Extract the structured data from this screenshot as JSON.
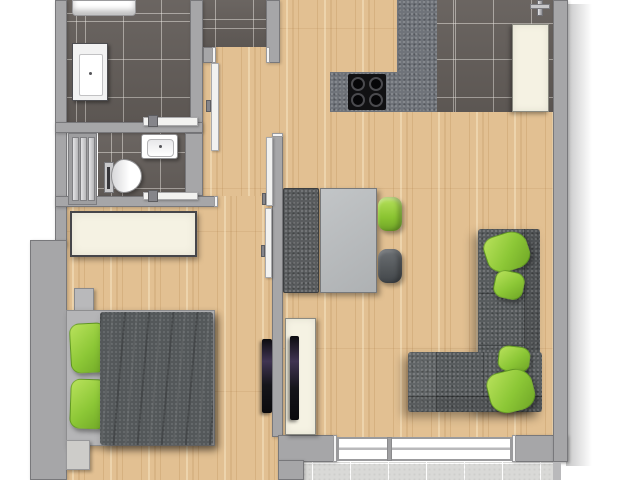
{
  "scene": {
    "kind": "apartment-floor-plan-top-down-render",
    "canvas": {
      "width": 640,
      "height": 480
    },
    "visible_text": "none"
  },
  "palette": {
    "outside_background": "#ffffff",
    "wall_fill": "#a6a6a8",
    "wall_border": "#78787b",
    "wall_cut_cap": "#f4f4f4",
    "wood_floor": "#e2c092",
    "wood_grain": "#ab7c42",
    "dark_tile_floor": "#635d59",
    "tile_grout": "#eeeae4",
    "balcony_tile": "#d9d9d7",
    "granite_counter": "#6f737a",
    "furniture_dark_gray": "#585c5e",
    "furniture_light_gray": "#b8bbbd",
    "cream_cabinet": "#f5f2e3",
    "accent_green": "#8fc63c",
    "appliance_black": "#141414",
    "tv_sheen_purple": "#403452"
  },
  "rooms": [
    {
      "id": "bathroom",
      "floor": "dark-tile",
      "contents": [
        "shower-tray",
        "washing-machine"
      ]
    },
    {
      "id": "wc",
      "floor": "dark-tile",
      "contents": [
        "shelf-unit",
        "sink",
        "toilet"
      ]
    },
    {
      "id": "entry-vestibule",
      "floor": "dark-tile",
      "contents": [
        "entry-door"
      ]
    },
    {
      "id": "hallway",
      "floor": "wood",
      "contents": [
        "sliding-door-bars",
        "interior-doors"
      ]
    },
    {
      "id": "kitchen",
      "floor": "dark-tile",
      "contents": [
        "l-shaped-granite-counter",
        "cooktop",
        "sink-faucet",
        "tall-cream-cabinet"
      ]
    },
    {
      "id": "living-dining",
      "floor": "wood",
      "contents": [
        "dining-bench",
        "dining-table",
        "green-chair",
        "gray-chair",
        "corner-sofa",
        "sofa-pillows",
        "tv-lowboard",
        "living-tv",
        "window-front"
      ]
    },
    {
      "id": "bedroom",
      "floor": "wood",
      "contents": [
        "wardrobe",
        "bed-frame",
        "green-pillows",
        "dark-duvet",
        "nightstand-top",
        "nightstand-bottom",
        "wall-tv"
      ]
    },
    {
      "id": "balcony",
      "floor": "light-tile",
      "contents": []
    }
  ],
  "furniture_colors": {
    "sofa": "#585c5e",
    "duvet": "#54585a",
    "pillows_and_chairs_accent": "#8fc63c",
    "dining_table": "#b8bbbd",
    "dining_bench": "#595c5e",
    "wardrobe_and_lowboard": "#f5f2e3",
    "cooktop": "#111111",
    "tvs": "#141418"
  },
  "counts": {
    "sofa_green_pillows": 4,
    "bed_green_pillows": 2,
    "cooktop_burners": 4,
    "window_panes": 2,
    "dining_chairs": 2
  }
}
